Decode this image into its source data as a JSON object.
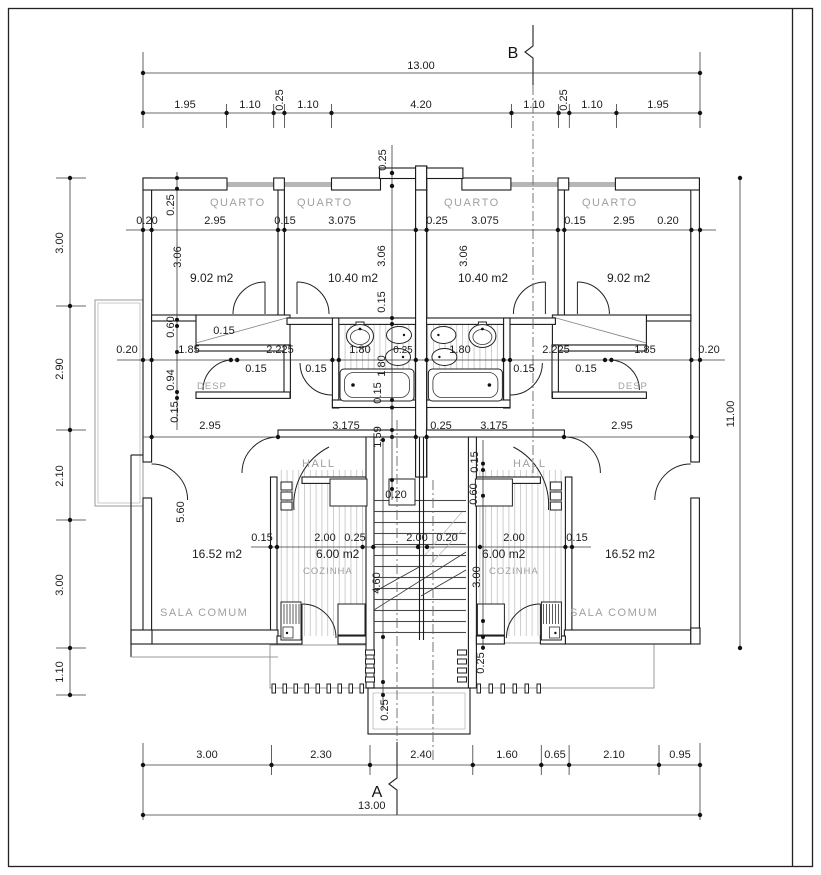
{
  "sections": {
    "a": "A",
    "b": "B"
  },
  "rooms": {
    "quarto": "QUARTO",
    "desp": "DESP",
    "hall": "HALL",
    "cozinha": "COZINHA",
    "sala_comum": "SALA COMUM"
  },
  "areas": {
    "quarto_small": "9.02 m2",
    "quarto_large": "10.40 m2",
    "sala": "16.52 m2",
    "cozinha": "6.00 m2"
  },
  "dims": {
    "total_width": "13.00",
    "total_height": "11.00",
    "top_chain": [
      "1.95",
      "1.10",
      "0.25",
      "1.10",
      "4.20",
      "1.10",
      "0.25",
      "1.10",
      "1.95"
    ],
    "left_chain": [
      "3.00",
      "2.90",
      "2.10",
      "3.00",
      "1.10"
    ],
    "bottom_chain": [
      "3.00",
      "2.30",
      "2.40",
      "1.60",
      "0.65",
      "2.10",
      "0.95"
    ],
    "quarto_line": [
      "0.20",
      "2.95",
      "0.15",
      "3.075",
      "0.25",
      "3.075",
      "0.15",
      "2.95",
      "0.20"
    ],
    "mid_line": [
      "0.20",
      "1.85",
      "2.225",
      "1.80",
      "0.25",
      "1.80",
      "2.225",
      "1.85",
      "0.20"
    ],
    "mid_below": [
      "0.15",
      "0.15",
      "0.15",
      "0.15"
    ],
    "hall_line": [
      "2.95",
      "3.175",
      "0.25",
      "3.175",
      "2.95"
    ],
    "kitchen_line": [
      "0.15",
      "2.00",
      "0.25",
      "2.00",
      "0.20",
      "2.00",
      "0.15"
    ],
    "v": {
      "d025": "0.25",
      "d306": "3.06",
      "d015": "0.15",
      "d180": "1.80",
      "d060": "0.60",
      "d094": "0.94",
      "d159": "1.59",
      "d560": "5.60",
      "d020": "0.20",
      "d300": "3.00",
      "d460": "4.60"
    }
  }
}
